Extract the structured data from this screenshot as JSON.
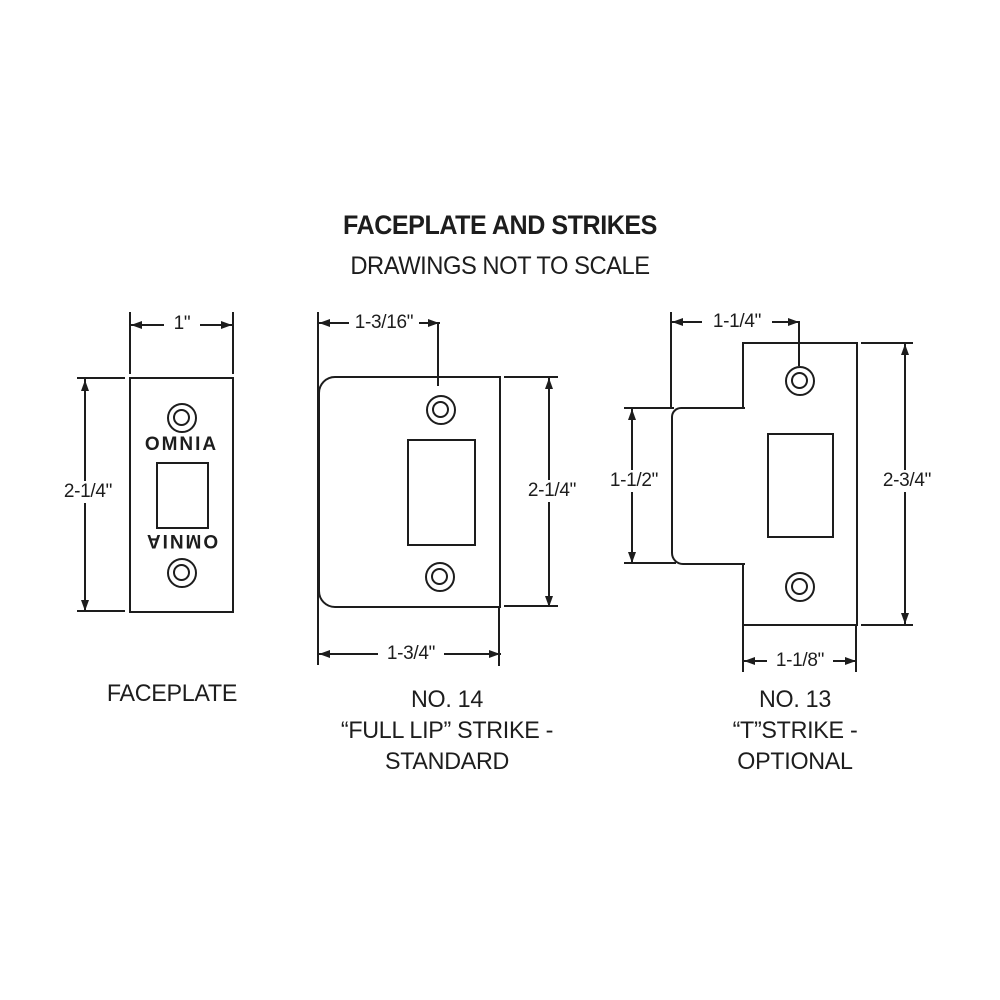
{
  "header": {
    "title": "FACEPLATE AND STRIKES",
    "subtitle": "DRAWINGS NOT TO SCALE"
  },
  "faceplate": {
    "caption": "FACEPLATE",
    "brand_text_top": "OMNIA",
    "brand_text_bottom": "OMNIA",
    "dims": {
      "width": "1\"",
      "height": "2-1/4\""
    }
  },
  "full_lip_strike": {
    "caption_lines": [
      "NO. 14",
      "“FULL LIP” STRIKE -",
      "STANDARD"
    ],
    "dims": {
      "top_width": "1-3/16\"",
      "height": "2-1/4\"",
      "bottom_width": "1-3/4\""
    }
  },
  "t_strike": {
    "caption_lines": [
      "NO. 13",
      "“T”STRIKE -",
      "OPTIONAL"
    ],
    "dims": {
      "top_width": "1-1/4\"",
      "lip_height": "1-1/2\"",
      "height": "2-3/4\"",
      "bottom_width": "1-1/8\""
    }
  },
  "colors": {
    "line": "#1d1d1d",
    "background": "#ffffff"
  }
}
